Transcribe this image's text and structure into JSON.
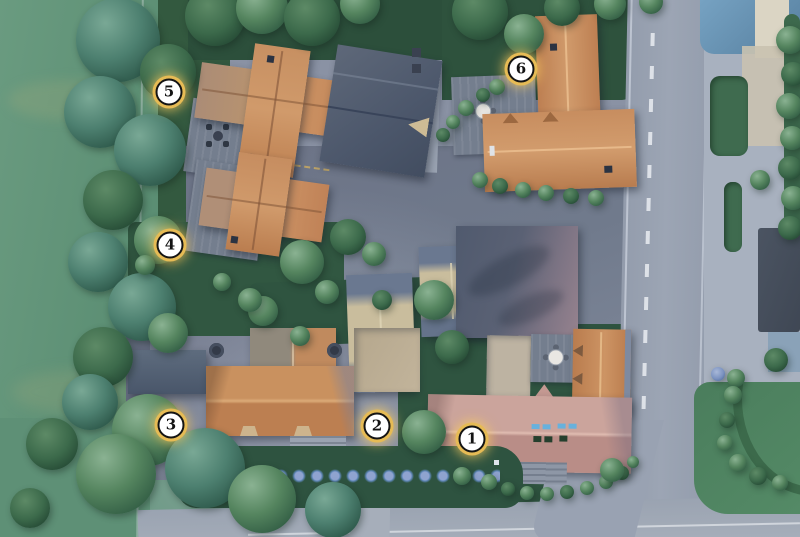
{
  "scene": {
    "title": "Aerial site plan of a six-plot residential development",
    "type": "3D rendered masterplan, top-down view",
    "markers": [
      {
        "label": "1",
        "x": 472,
        "y": 439
      },
      {
        "label": "2",
        "x": 377,
        "y": 426
      },
      {
        "label": "3",
        "x": 171,
        "y": 425
      },
      {
        "label": "4",
        "x": 170,
        "y": 245
      },
      {
        "label": "5",
        "x": 169,
        "y": 92
      },
      {
        "label": "6",
        "x": 521,
        "y": 69
      }
    ],
    "plots": [
      {
        "number": "1",
        "description": "Detached house with salmon hipped roof, bottom right corner plot"
      },
      {
        "number": "2",
        "description": "Central plot sharing large terracotta-roof house, driveway side"
      },
      {
        "number": "3",
        "description": "Central plot sharing large terracotta-roof house, garden side"
      },
      {
        "number": "4",
        "description": "Terracotta-roof cottage with rear deck, mid left"
      },
      {
        "number": "5",
        "description": "Terracotta cross-gable house with deck, top left"
      },
      {
        "number": "6",
        "description": "L-shaped terracotta-roof house with patio, top right"
      }
    ],
    "palette": {
      "field_grass": "#5f9178",
      "lawn_dark": "#2f5440",
      "tree_foliage": "#4e8065",
      "roof_terracotta": "#c98f63",
      "roof_salmon": "#c49992",
      "roof_slate": "#556074",
      "roof_blue": "#6f9cbd",
      "driveway": "#6d7487",
      "road": "#99a2b2",
      "sidewalk": "#a8b1bf",
      "marker_ring_gold": "#e6bb55",
      "marker_face": "#ffffff",
      "marker_number": "#141414"
    }
  }
}
